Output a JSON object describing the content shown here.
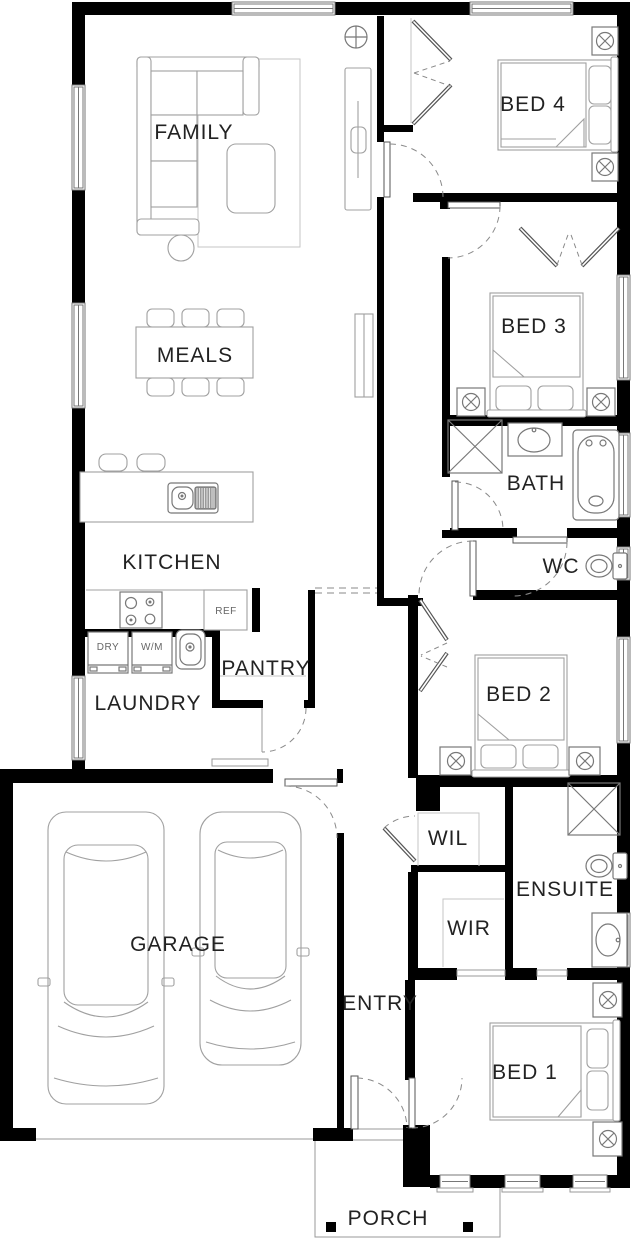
{
  "plan_title": "House floor plan",
  "rooms": {
    "family": {
      "label": "FAMILY"
    },
    "meals": {
      "label": "MEALS"
    },
    "kitchen": {
      "label": "KITCHEN"
    },
    "pantry": {
      "label": "PANTRY"
    },
    "laundry": {
      "label": "LAUNDRY"
    },
    "garage": {
      "label": "GARAGE"
    },
    "entry": {
      "label": "ENTRY"
    },
    "porch": {
      "label": "PORCH"
    },
    "wil": {
      "label": "WIL"
    },
    "wir": {
      "label": "WIR"
    },
    "ensuite": {
      "label": "ENSUITE"
    },
    "bath": {
      "label": "BATH"
    },
    "wc": {
      "label": "WC"
    },
    "bed1": {
      "label": "BED 1"
    },
    "bed2": {
      "label": "BED 2"
    },
    "bed3": {
      "label": "BED 3"
    },
    "bed4": {
      "label": "BED 4"
    }
  },
  "appliances": {
    "dryer": {
      "label": "DRY"
    },
    "washer": {
      "label": "W/M"
    },
    "fridge": {
      "label": "REF"
    }
  },
  "colors": {
    "wall": "#000000",
    "furniture": "#a0a0a0",
    "fixture": "#787878",
    "text": "#222222",
    "background": "#ffffff"
  }
}
